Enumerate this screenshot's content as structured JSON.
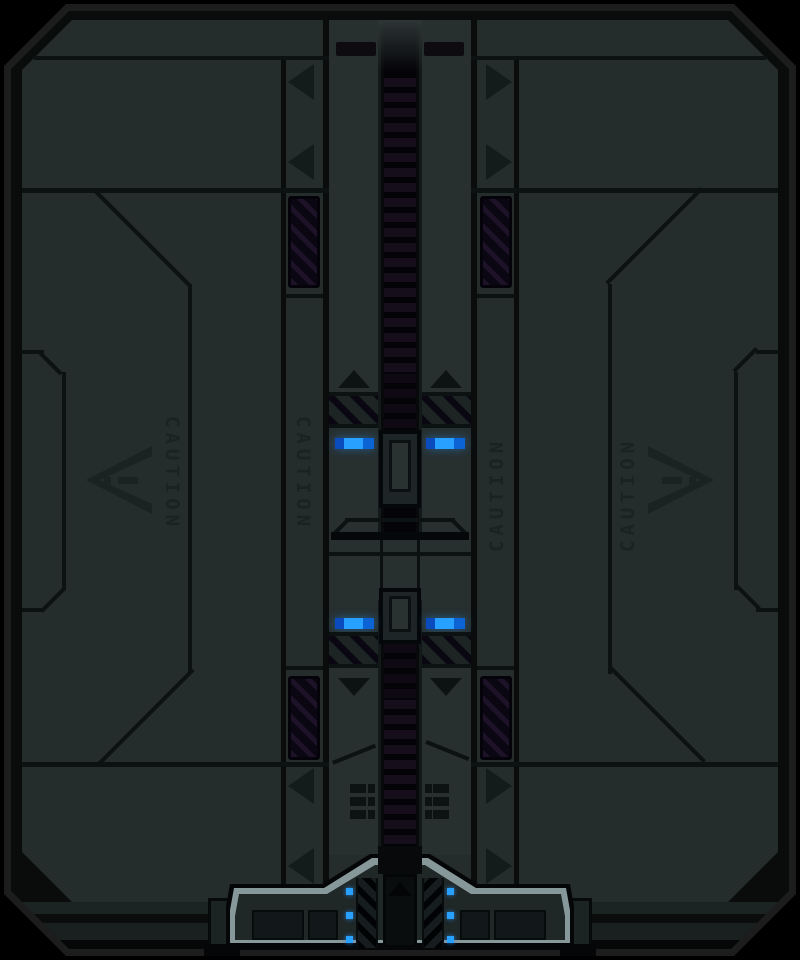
{
  "scene": {
    "object_label": "sci-fi blast door",
    "style": "pixel-art sprite"
  },
  "door": {
    "caution_label": "CAUTION",
    "caution_label_count": 4,
    "warning_triangle_count": 2,
    "side_arrow_marker_count": 8,
    "lights": {
      "upper_blue_bars": 2,
      "lower_blue_bars": 2,
      "base_blue_dots_per_side": 3,
      "accent_color": "#28a0ff"
    },
    "colors": {
      "bg": "#000000",
      "rim": "#1c1d1c",
      "groove": "#0a0c0c",
      "door": "#242c2c",
      "door2": "#272f2f",
      "line": "#0c1111",
      "etch": "#1a2222",
      "marker": "#141b1b",
      "marker-dark": "#0d1313",
      "hazard-bg": "#0b0712",
      "hazard-stripe": "#1d1227",
      "channel": "#040307",
      "rung": "#160e1b",
      "accent": "#28a0ff",
      "accent-dark": "#0a4cbe",
      "accent-mid": "#0c63d4",
      "base-highlight": "#87989b",
      "base-fill": "#1f2727",
      "base-dark": "#040607"
    }
  }
}
